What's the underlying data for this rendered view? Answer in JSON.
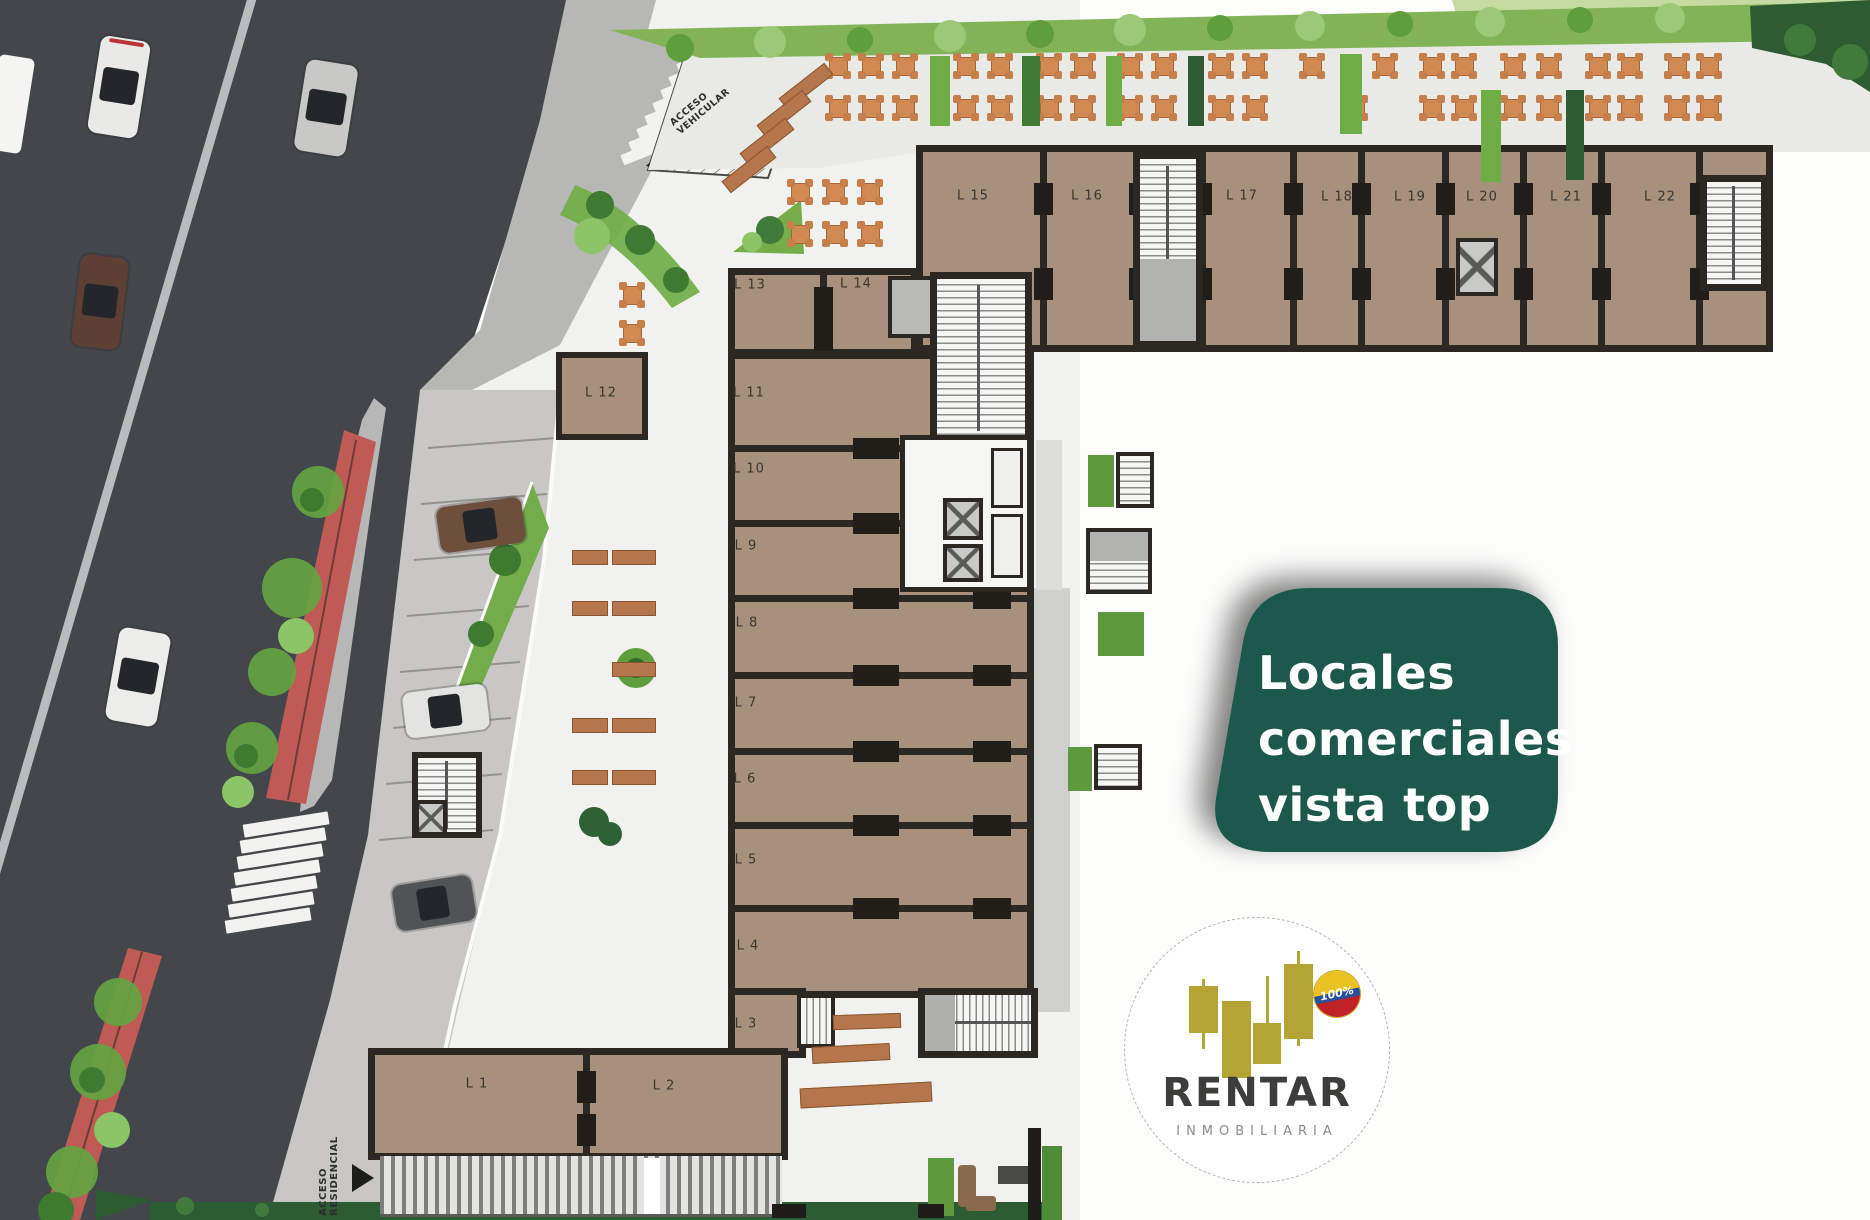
{
  "badge": {
    "lines": [
      "Locales",
      "comerciales",
      "vista top"
    ]
  },
  "logo": {
    "brand": "RENTAR",
    "subtitle": "INMOBILIARIA",
    "seal": "100%"
  },
  "plan": {
    "units": [
      "L 1",
      "L 2",
      "L 3",
      "L 4",
      "L 5",
      "L 6",
      "L 7",
      "L 8",
      "L 9",
      "L 10",
      "L 11",
      "L 12",
      "L 13",
      "L 14",
      "L 15",
      "L 16",
      "L 17",
      "L 18",
      "L 19",
      "L 20",
      "L 21",
      "L 22"
    ],
    "access": {
      "vehicular": [
        "ACCESO",
        "VEHICULAR"
      ],
      "residential": [
        "ACCESO",
        "RESIDENCIAL"
      ]
    }
  },
  "colors": {
    "badge_bg": "#1b584c",
    "badge_text": "#ffffff",
    "logo_gold": "#b3a433",
    "brand_text": "#3d3d3b",
    "subtitle_text": "#8a8a88",
    "seal_yellow": "#e8c322",
    "seal_blue": "#27519b",
    "seal_red": "#c02127",
    "asphalt": "#43474c",
    "lane_line": "#b9bbbc",
    "bike_lane": "#bf5a54",
    "sidewalk": "#b7b8b6",
    "pavers": "#c8c7c5",
    "plaza": "#f1f2ef",
    "terrace": "#e9e9e6",
    "hedge": "#82b457",
    "building_fill": "#a7917d",
    "building_wall": "#2b2823",
    "wood": "#b4764a",
    "table": "#d18a52"
  }
}
